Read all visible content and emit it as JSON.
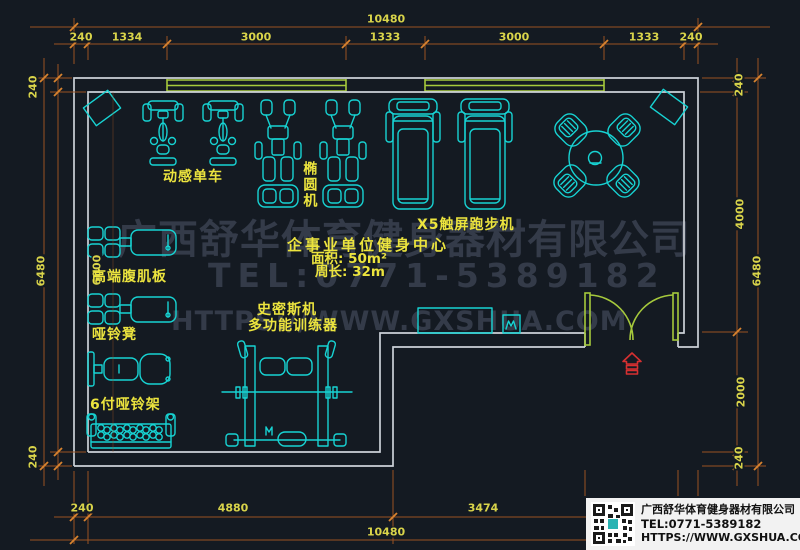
{
  "colors": {
    "background": "#141a22",
    "wall": "#ccd1d8",
    "equipment_cyan": "#17d3d3",
    "window_door_green": "#a6c93c",
    "dimension_line_orange": "#9a5222",
    "dimension_text_yellow": "#d9d44a",
    "label_yellow": "#ece43e",
    "entrance_red": "#d63031",
    "watermark_gray": "#343b49",
    "logo_box_background": "#f2f2f2"
  },
  "dims": {
    "top": {
      "overall": "10480",
      "segs": [
        "240",
        "1334",
        "3000",
        "1333",
        "3000",
        "1333",
        "240"
      ]
    },
    "bottom": {
      "overall": "10480",
      "segs": [
        "240",
        "4880",
        "3474"
      ]
    },
    "left": {
      "overall": "6480",
      "segs": [
        "240",
        "6000",
        "240"
      ]
    },
    "right": {
      "overall": "6480",
      "segs": [
        "240",
        "4000",
        "2000",
        "240"
      ]
    }
  },
  "equipment_labels": {
    "spin_bike": "动感单车",
    "elliptical": "椭圆机",
    "treadmill": "X5触屏跑步机",
    "ab_board": "高端腹肌板",
    "dumbbell_bench": "哑铃凳",
    "dumbbell_rack": "6付哑铃架",
    "smith_machine": "史密斯机",
    "multi_trainer": "多功能训练器"
  },
  "info": {
    "title": "企事业单位健身中心",
    "area": "面积: 50m²",
    "perimeter": "周长: 32m"
  },
  "watermark": {
    "company": "广西舒华体育健身器材有限公司",
    "tel": "TEL:0771-5389182",
    "url": "HTTPS://WWW.GXSHUA.COM"
  },
  "logo": {
    "company": "广西舒华体育健身器材有限公司",
    "tel": "TEL:0771-5389182",
    "url": "HTTPS://WWW.GXSHUA.COM"
  }
}
